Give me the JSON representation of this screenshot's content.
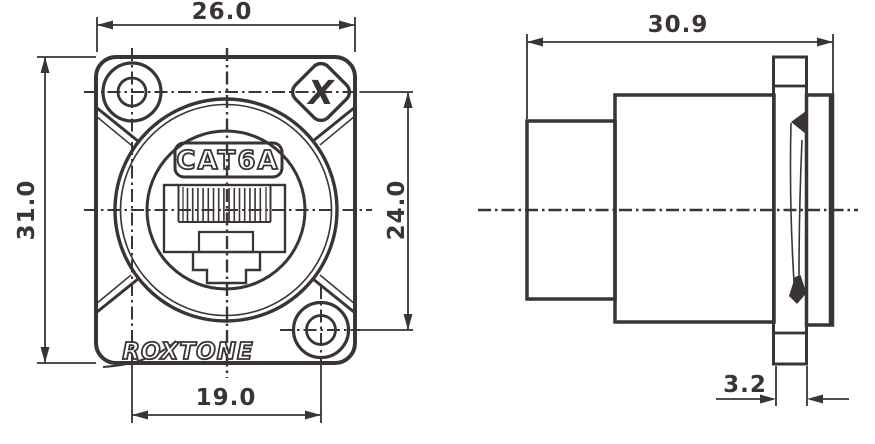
{
  "drawing": {
    "type": "technical-dimension-drawing",
    "product": {
      "category_label": "CAT6A",
      "brand": "ROXTONE",
      "brand_mark": "X"
    },
    "front_view": {
      "name": "front-panel-view",
      "dimensions": {
        "overall_width": "26.0",
        "overall_height": "31.0",
        "hole_span_vertical": "24.0",
        "hole_span_horizontal": "19.0"
      }
    },
    "side_view": {
      "name": "side-profile-view",
      "dimensions": {
        "overall_depth": "30.9",
        "flange_thickness": "3.2"
      }
    },
    "colors": {
      "line": "#3a3432",
      "background": "#ffffff"
    }
  }
}
